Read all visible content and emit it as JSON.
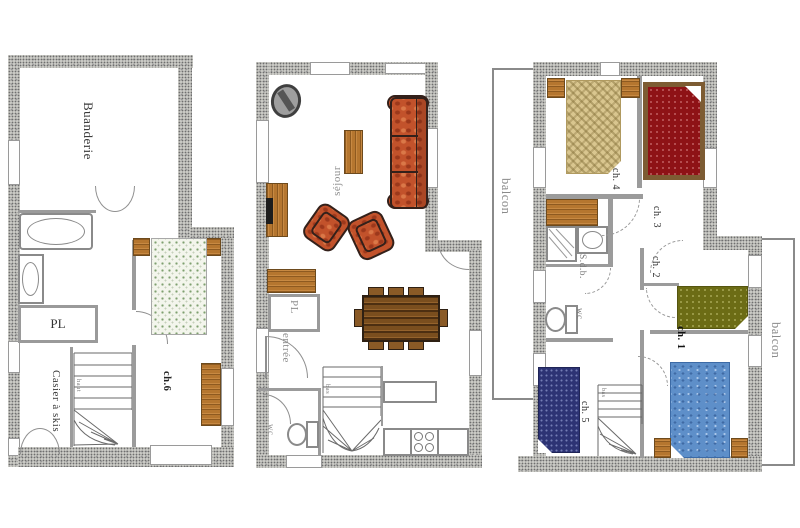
{
  "plans": [
    {
      "id": "level-1",
      "rooms": {
        "buanderie": "Buanderie",
        "pl": "PL",
        "casier_skis": "Casier à skis",
        "ch6": "ch.6"
      },
      "stair_label": "haut"
    },
    {
      "id": "level-2",
      "rooms": {
        "sejour": "séjour",
        "entree": "entrée",
        "pl": "PL",
        "wc": "wc"
      },
      "stair_label": "bas"
    },
    {
      "id": "level-3",
      "rooms": {
        "balcon_left": "balcon",
        "balcon_right": "balcon",
        "ch4": "ch. 4",
        "ch3": "ch. 3",
        "ch2": "ch. 2",
        "ch1": "ch. 1",
        "ch5": "ch. 5",
        "sdb": "S.d.b.",
        "wc": "wc"
      },
      "stair_label": "bas"
    }
  ],
  "colors": {
    "wall_speckle": "#c9c9c4",
    "wood": "#b5762f",
    "table_wood": "#7a4e1e",
    "sofa": "#c2522b",
    "bed_ch6": "#f3f5ec",
    "bed_ch4": "#d9c68f",
    "bed_ch3": "#8e1216",
    "bed_ch2": "#6c6c15",
    "bed_ch1": "#5e8fc9",
    "bed_ch5": "#2d3374",
    "stove": "#9e9e9e"
  }
}
